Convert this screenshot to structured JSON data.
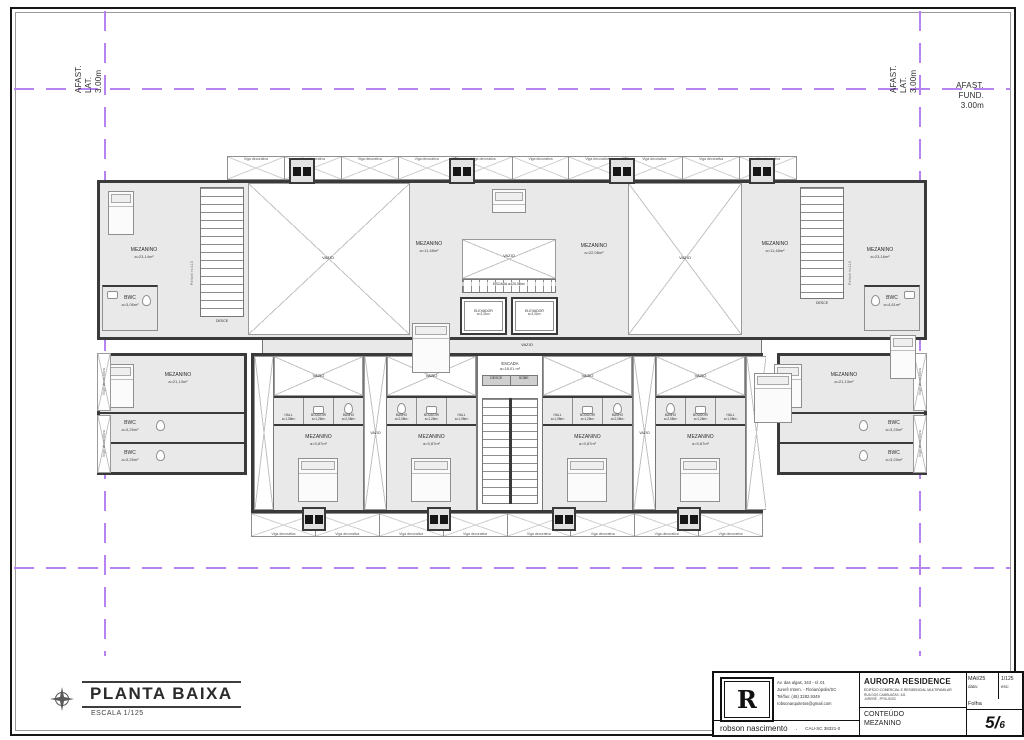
{
  "margins": {
    "afast_lat_lines": [
      "AFAST.",
      "LAT.",
      "3.00m"
    ],
    "afast_fund_lines": [
      "AFAST.",
      "FUND.",
      "3.00m"
    ]
  },
  "plan": {
    "viga_label": "Viga decorativa",
    "vazio": "VAZIO",
    "desce": "DESCE",
    "sobe": "SOBE",
    "peitoril": "Peitoril h=110",
    "rooms": {
      "mez_tl": {
        "name": "MEZANINO",
        "area": "a=23,14m²"
      },
      "mez_lc": {
        "name": "MEZANINO",
        "area": "a=11,48m²"
      },
      "mez_tc": {
        "name": "MEZANINO",
        "area": "a=22,08m²"
      },
      "mez_tr1": {
        "name": "MEZANINO",
        "area": "a=11,48m²"
      },
      "mez_tr2": {
        "name": "MEZANINO",
        "area": "a=23,16m²"
      },
      "mez_ml": {
        "name": "MEZANINO",
        "area": "a=21,13m²"
      },
      "mez_mr": {
        "name": "MEZANINO",
        "area": "a=21,13m²"
      },
      "mez_low": {
        "name": "MEZANINO",
        "area": "a=9,87m²"
      },
      "bwc_tl": {
        "name": "BWC",
        "area": "a=3,06m²"
      },
      "bwc_tr": {
        "name": "BWC",
        "area": "a=4,61m²"
      },
      "bwc_mid": {
        "name": "BWC",
        "area": "a=3,25m²"
      },
      "hall": {
        "name": "HALL",
        "area": "a=1,08m²"
      },
      "boudoir": {
        "name": "BOUDOIR",
        "area": "a=1,26m²"
      },
      "banho": {
        "name": "BANHO",
        "area": "a=2,08m²"
      },
      "elevador": {
        "name": "ELEVADOR",
        "area": "a=3,31m²"
      },
      "escada_upper": {
        "name": "ESCADA",
        "area": "a=20,06m²"
      },
      "escada_lower": {
        "name": "ESCADA",
        "area": "a=18,01 m²"
      }
    }
  },
  "footer": {
    "plan_title": "PLANTA BAIXA",
    "plan_scale": "ESCALA 1/125",
    "firm": "robson nascimento",
    "firm_sep": ".",
    "cau": "CAU-SC 38321-0",
    "logo_letter": "R",
    "address_lines": [
      "Av. das algas, 343 - sl .01",
      "Jurerê Intern. - Florianópolis/SC",
      "Tel/fax: (48) 3282.9349",
      "robsonarquitetos@gmail.com"
    ],
    "project": "AURORA RESIDENCE",
    "project_sub1": "EDIFÍCIO COMERCIAL E RESIDENCIAL MULTIFAMILAR",
    "project_sub2": "RUA DOS CAMBUATAS, 341",
    "project_sub3": "JURERÊ - FPOLIS/SC",
    "date_value": "MAI/25",
    "date_label": "data:",
    "scale_value": "1/125",
    "scale_label": "esc:",
    "sheet_label": "Folha",
    "conteudo_label": "CONTEÚDO",
    "conteudo_value": "MEZANINO",
    "sheet_num_main": "5/",
    "sheet_num_sub": "6"
  },
  "colors": {
    "setback": "#b584f2",
    "wall": "#3a3a3a",
    "room_fill": "#e9e9e9"
  }
}
